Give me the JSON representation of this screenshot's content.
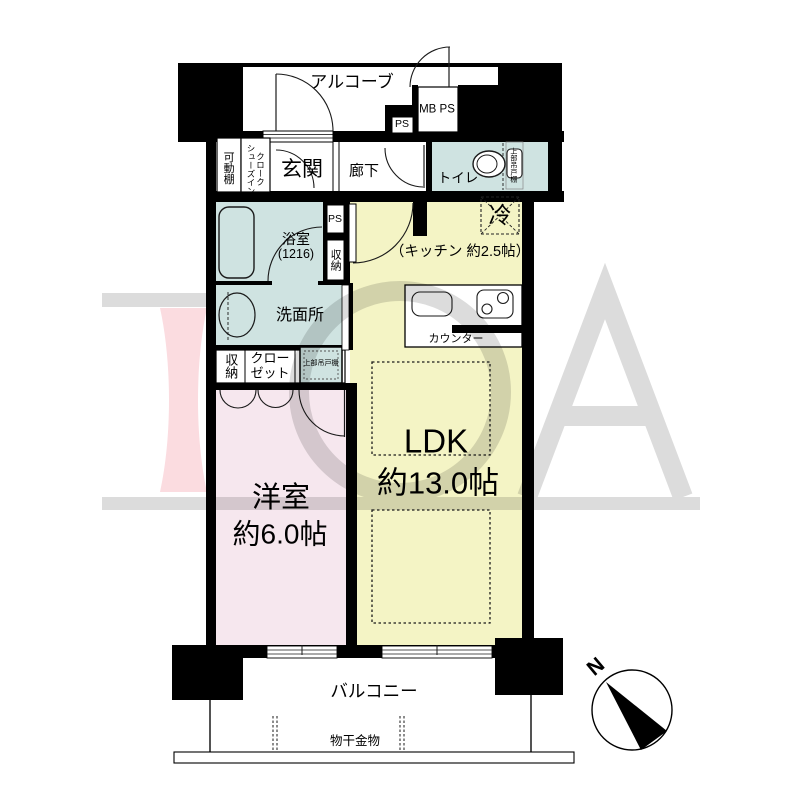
{
  "plan_title": "1LDK apartment floor plan",
  "rooms": {
    "alcove": "アルコーブ",
    "entrance": "玄関",
    "hallway": "廊下",
    "toilet": "トイレ",
    "bath": "浴室",
    "bath_size": "(1216)",
    "washroom": "洗面所",
    "western_room": "洋室",
    "western_room_size": "約6.0帖",
    "ldk": "LDK",
    "ldk_size": "約13.0帖",
    "kitchen_note": "（キッチン 約2.5帖）",
    "balcony": "バルコニー"
  },
  "labels": {
    "mb_ps": "MB PS",
    "ps_top": "PS",
    "ps_shaft": "PS",
    "storage_shaft": "収納",
    "storage_closet": "収納",
    "closet": "クローゼット",
    "movable_shelf": "可動棚",
    "shoes_in_closet": "シューズインクローク",
    "upper_cabinet_closet": "上部吊戸棚",
    "upper_cabinet_toilet": "上部吊戸棚",
    "refrigerator": "冷",
    "counter": "カウンター",
    "laundry_hardware": "物干金物",
    "north": "N"
  },
  "icons": {
    "compass_icon": "compass with north needle",
    "bathtub_icon": "bathtub",
    "toilet_icon": "toilet bowl",
    "sink_icon": "wash basin",
    "stove_icon": "two-burner stove",
    "kitchen_sink_icon": "kitchen sink"
  },
  "colors": {
    "wall": "#000000",
    "ldk_fill": "#f4f4c5",
    "western_room_fill": "#f6e7ee",
    "wet_area_fill": "#cfe3e1",
    "watermark_gray": "#dcdcdc",
    "watermark_pink": "#fbdce0",
    "background": "#ffffff"
  }
}
